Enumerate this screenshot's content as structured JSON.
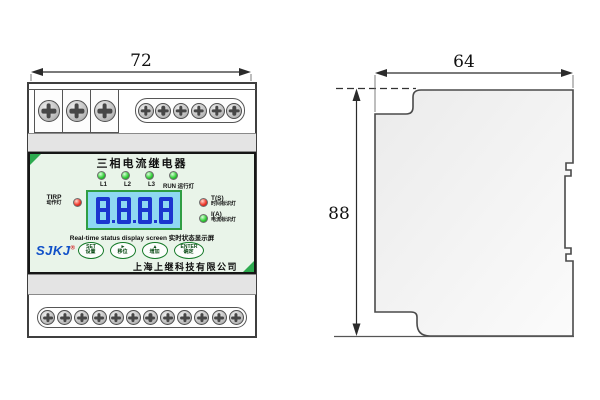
{
  "dimensions": {
    "front_width": "72",
    "side_depth": "64",
    "side_height": "88"
  },
  "front_view": {
    "terminals": {
      "top_cell_screws": 3,
      "top_strip_screws": 6,
      "bottom_strip_screws": 12
    },
    "panel": {
      "title": "三相电流继电器",
      "phase_leds": [
        {
          "label": "L1",
          "sub": ""
        },
        {
          "label": "L2",
          "sub": ""
        },
        {
          "label": "L3",
          "sub": ""
        },
        {
          "label": "RUN",
          "sub": "运行灯"
        }
      ],
      "trip_led": {
        "label": "TIRP",
        "sub": "动作灯"
      },
      "time_led": {
        "label": "T(S)",
        "sub": "时间标识灯"
      },
      "current_led": {
        "label": "I(A)",
        "sub": "电流标识灯"
      },
      "display": {
        "value": "8.8.8.8",
        "caption": "Real-time status display screen 实时状态显示屏"
      },
      "brand": {
        "name": "SJKJ",
        "mark": "®"
      },
      "buttons": [
        {
          "key": "SET",
          "cn": "设置"
        },
        {
          "key": "►",
          "cn": "移位"
        },
        {
          "key": "▲",
          "cn": "增加"
        },
        {
          "key": "ENTER",
          "cn": "确定"
        }
      ],
      "company": "上海上继科技有限公司"
    }
  },
  "colors": {
    "panel_bg": "#e9f4e9",
    "lcd_bg": "#8ed9f2",
    "lcd_segment": "#1b35cf",
    "lcd_border": "#2f9e44",
    "button_green": "#157a28",
    "brand_blue": "#1050c8",
    "corner_green": "#2daa4f"
  }
}
